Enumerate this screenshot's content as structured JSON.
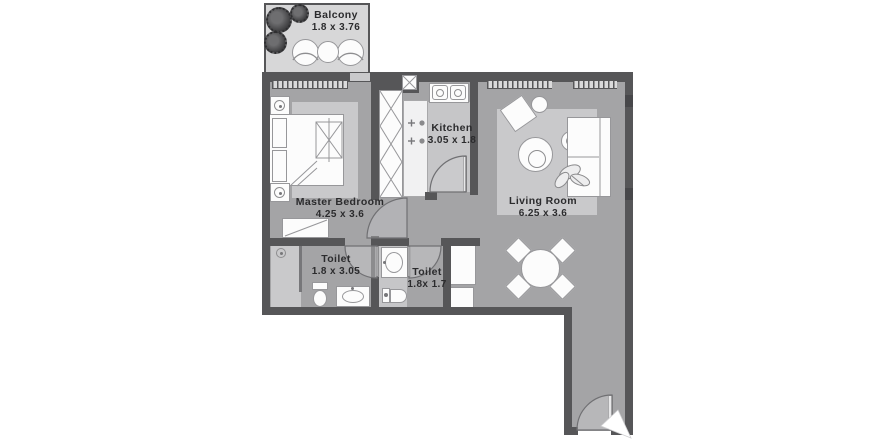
{
  "plan": {
    "rooms": [
      {
        "id": "balcony",
        "label": "Balcony",
        "dims": "1.8 x 3.76"
      },
      {
        "id": "master-bedroom",
        "label": "Master Bedroom",
        "dims": "4.25 x 3.6"
      },
      {
        "id": "kitchen",
        "label": "Kitchen",
        "dims": "3.05 x 1.8"
      },
      {
        "id": "toilet-1",
        "label": "Toilet",
        "dims": "1.8 x 3.05"
      },
      {
        "id": "toilet-2",
        "label": "Toilet",
        "dims": "1.8x 1.7"
      },
      {
        "id": "living-room",
        "label": "Living Room",
        "dims": "6.25 x 3.6"
      }
    ],
    "colors": {
      "wall": "#565658",
      "floor": "#a4a4a6",
      "floor_light": "#c9c9cb",
      "balcony_floor": "#d7d7d8",
      "fixture_white": "#fcfcfc",
      "outline": "#97979a",
      "text": "#2b2b2d",
      "background": "#ffffff"
    },
    "icons": [
      "plant-icon",
      "bed-icon",
      "lamp-icon",
      "wardrobe-icon",
      "stove-icon",
      "kitchen-sink-icon",
      "shower-icon",
      "toilet-icon",
      "vanity-sink-icon",
      "sofa-icon",
      "armchair-icon",
      "coffee-table-icon",
      "side-table-icon",
      "dining-table-icon",
      "dining-chair-icon",
      "door-swing-icon",
      "window-icon",
      "entry-arrow-icon",
      "closet-icon",
      "dresser-icon",
      "balcony-chair-icon",
      "balcony-table-icon"
    ]
  }
}
